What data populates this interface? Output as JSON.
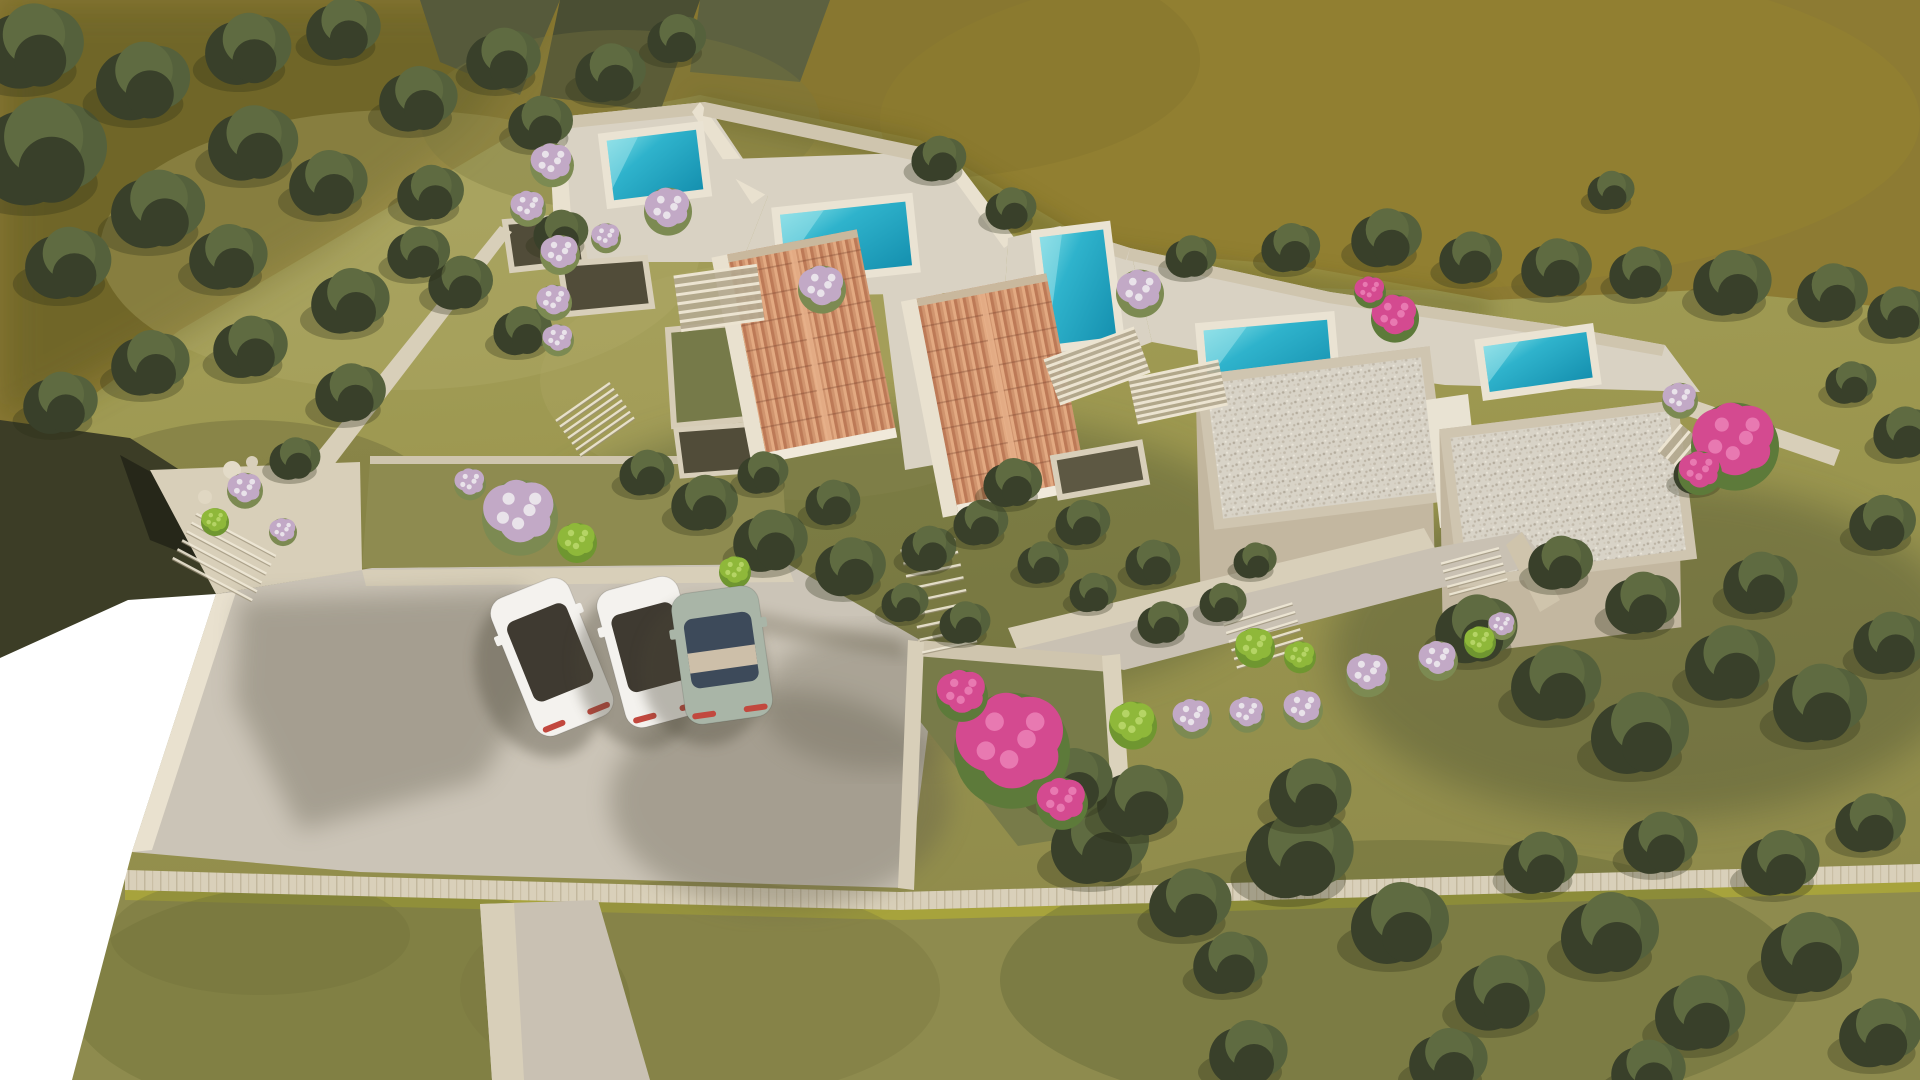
{
  "meta": {
    "title": "Aerial 3D architectural rendering - hillside villa complex",
    "description": "Top-down aerial render of a terraced Mediterranean villa development on an olive hillside: five turquoise pools, two terracotta gable roofs, two gravel flat-roof volumes, stone retaining walls, bougainvillea and lilac shrubs, a beige parking court with three parked cars, long stone boundary wall with lawn below, and an unrendered white wedge at the lower left."
  },
  "counts": {
    "pools": 5,
    "cars": 3,
    "terracotta_roofs": 2,
    "gravel_roof_volumes": 2,
    "pergola_stairs": 4
  },
  "palette": {
    "upland": "#8d7b33",
    "upland_shadow": "#6b6228",
    "cliff_a": "#565a3b",
    "cliff_b": "#4a4e33",
    "cliff_c": "#5d6140",
    "hill_base": "#9f9a58",
    "hill_light": "#b2ad6a",
    "hill_dark": "#75733f",
    "dark_wedge": "#3c3d26",
    "dark_wedge_deep": "#20221697",
    "white_cut": "#ffffff",
    "lawn": "#8e8b4e",
    "lawn_stripe": "#a7a33c",
    "lawn_dark": "#6f7038",
    "terrace": "#d9d2c3",
    "terrace_bright": "#e9e1cf",
    "stone_rim": "#cfc5ae",
    "stone_wall": "#d8cfb9",
    "wall_shade": "#b4a98f",
    "well_dark": "#514c39",
    "court_green": "#767a49",
    "parking": "#cbc4b7",
    "parking_shadow": "#5f5a4880",
    "path": "#c9c1b3",
    "pool_coping": "#eae3d3",
    "pool_light": "#9ae2e9",
    "tree_dark": "#39402a",
    "tree_mid": "#55613c",
    "tree_light": "#5f6b41",
    "tree_shadow": "#2a2f17",
    "bush_leaf": "#7c8a52",
    "car_white": "#f4f2ee",
    "car_sage": "#a9b5a7",
    "car_glass_dark": "#3f3a31",
    "car_glass_blue": "#3d4a5a",
    "car_taillight": "#c2483e",
    "slat_base": "#b3a88f",
    "slat_line": "#ece4d1",
    "step_line": "#efe8d6"
  },
  "bush_styles": {
    "lilac": {
      "main": "#c2a9c6",
      "hi": "#e9e3ea",
      "leaf": "#7c8a52"
    },
    "pink": {
      "main": "#d44a90",
      "hi": "#e879b1",
      "leaf": "#5d7a3a"
    },
    "green": {
      "main": "#8fb83a",
      "hi": "#b5d465",
      "leaf": "#6f9630"
    }
  },
  "scene": {
    "pools": [
      {
        "name": "pool-upper-left",
        "x": 655,
        "y": 165,
        "w": 90,
        "h": 60,
        "rot": -7
      },
      {
        "name": "pool-center",
        "x": 846,
        "y": 240,
        "w": 126,
        "h": 64,
        "rot": -6
      },
      {
        "name": "pool-mid-right",
        "x": 1078,
        "y": 287,
        "w": 64,
        "h": 108,
        "rot": -7
      },
      {
        "name": "pool-right",
        "x": 1268,
        "y": 356,
        "w": 124,
        "h": 62,
        "rot": -5
      },
      {
        "name": "pool-far-right",
        "x": 1538,
        "y": 362,
        "w": 104,
        "h": 46,
        "rot": -8
      }
    ],
    "pergolas": [
      {
        "x": 719,
        "y": 298,
        "w": 84,
        "h": 54,
        "rot": -8,
        "lines": 7
      },
      {
        "x": 1097,
        "y": 366,
        "w": 96,
        "h": 46,
        "rot": -20,
        "lines": 8
      },
      {
        "x": 1178,
        "y": 392,
        "w": 92,
        "h": 44,
        "rot": -12,
        "lines": 8
      },
      {
        "x": 1690,
        "y": 455,
        "w": 36,
        "h": 52,
        "rot": -50,
        "lines": 6
      }
    ],
    "stairs": [
      {
        "x": 583,
        "y": 402,
        "rot": -35,
        "len": 66,
        "count": 7,
        "gap": 7
      },
      {
        "x": 928,
        "y": 545,
        "rot": -12,
        "len": 56,
        "count": 9,
        "gap": 13
      },
      {
        "x": 1258,
        "y": 614,
        "rot": -17,
        "len": 72,
        "count": 6,
        "gap": 9
      },
      {
        "x": 1470,
        "y": 556,
        "rot": -15,
        "len": 60,
        "count": 5,
        "gap": 8
      },
      {
        "x": 236,
        "y": 535,
        "rot": 28,
        "len": 90,
        "count": 6,
        "gap": 10
      }
    ],
    "cars": [
      {
        "name": "car-white-1",
        "x": 552,
        "y": 657,
        "w": 84,
        "h": 148,
        "rot": -22,
        "body": "car_white",
        "glass": "car_glass_dark",
        "band": false
      },
      {
        "name": "car-white-2",
        "x": 652,
        "y": 652,
        "w": 84,
        "h": 142,
        "rot": -15,
        "body": "car_white",
        "glass": "car_glass_dark",
        "band": false
      },
      {
        "name": "car-sage",
        "x": 722,
        "y": 655,
        "w": 88,
        "h": 132,
        "rot": -8,
        "body": "car_sage",
        "glass": "car_glass_blue",
        "band": true
      }
    ],
    "trees": [
      [
        45,
        150,
        66
      ],
      [
        35,
        45,
        52
      ],
      [
        145,
        80,
        48
      ],
      [
        250,
        48,
        44
      ],
      [
        345,
        28,
        38
      ],
      [
        255,
        142,
        46
      ],
      [
        160,
        208,
        48
      ],
      [
        70,
        262,
        44
      ],
      [
        230,
        256,
        40
      ],
      [
        330,
        182,
        40
      ],
      [
        420,
        98,
        40
      ],
      [
        505,
        58,
        38
      ],
      [
        432,
        192,
        34
      ],
      [
        352,
        300,
        40
      ],
      [
        252,
        346,
        38
      ],
      [
        152,
        362,
        40
      ],
      [
        62,
        402,
        38
      ],
      [
        462,
        282,
        33
      ],
      [
        542,
        122,
        33
      ],
      [
        612,
        72,
        36
      ],
      [
        678,
        38,
        30
      ],
      [
        562,
        232,
        28
      ],
      [
        524,
        330,
        30
      ],
      [
        420,
        252,
        32
      ],
      [
        352,
        392,
        36
      ],
      [
        296,
        458,
        26
      ],
      [
        940,
        158,
        28
      ],
      [
        1012,
        208,
        26
      ],
      [
        1192,
        256,
        26
      ],
      [
        1292,
        247,
        30
      ],
      [
        1388,
        237,
        36
      ],
      [
        1472,
        257,
        32
      ],
      [
        1558,
        267,
        36
      ],
      [
        1642,
        272,
        32
      ],
      [
        1734,
        282,
        40
      ],
      [
        1834,
        292,
        36
      ],
      [
        1900,
        312,
        32
      ],
      [
        1612,
        190,
        24
      ],
      [
        648,
        472,
        28
      ],
      [
        706,
        502,
        34
      ],
      [
        772,
        540,
        38
      ],
      [
        852,
        566,
        36
      ],
      [
        930,
        548,
        28
      ],
      [
        764,
        472,
        26
      ],
      [
        834,
        502,
        28
      ],
      [
        982,
        522,
        28
      ],
      [
        1044,
        562,
        26
      ],
      [
        906,
        602,
        24
      ],
      [
        966,
        622,
        26
      ],
      [
        1094,
        592,
        24
      ],
      [
        1164,
        622,
        26
      ],
      [
        1014,
        482,
        30
      ],
      [
        1084,
        522,
        28
      ],
      [
        1154,
        562,
        28
      ],
      [
        1224,
        602,
        24
      ],
      [
        1256,
        560,
        22
      ],
      [
        1478,
        628,
        42
      ],
      [
        1558,
        682,
        46
      ],
      [
        1642,
        732,
        50
      ],
      [
        1732,
        662,
        46
      ],
      [
        1822,
        702,
        48
      ],
      [
        1892,
        642,
        38
      ],
      [
        1762,
        582,
        38
      ],
      [
        1644,
        602,
        38
      ],
      [
        1562,
        562,
        33
      ],
      [
        1884,
        522,
        34
      ],
      [
        1906,
        432,
        32
      ],
      [
        1852,
        382,
        26
      ],
      [
        1700,
        472,
        26
      ],
      [
        1102,
        842,
        50
      ],
      [
        1192,
        902,
        42
      ],
      [
        1302,
        852,
        55
      ],
      [
        1232,
        962,
        38
      ],
      [
        1402,
        922,
        50
      ],
      [
        1502,
        992,
        46
      ],
      [
        1612,
        932,
        50
      ],
      [
        1702,
        1012,
        46
      ],
      [
        1812,
        952,
        50
      ],
      [
        1882,
        1032,
        42
      ],
      [
        1542,
        862,
        38
      ],
      [
        1662,
        842,
        38
      ],
      [
        1782,
        862,
        40
      ],
      [
        1872,
        822,
        36
      ],
      [
        1142,
        800,
        44
      ],
      [
        1312,
        792,
        42
      ],
      [
        1250,
        1052,
        40
      ],
      [
        1450,
        1060,
        40
      ],
      [
        1650,
        1070,
        38
      ],
      [
        1075,
        780,
        40
      ]
    ],
    "bushes": [
      [
        552,
        162,
        22,
        "lilac"
      ],
      [
        528,
        206,
        18,
        "lilac"
      ],
      [
        560,
        252,
        20,
        "lilac"
      ],
      [
        554,
        300,
        18,
        "lilac"
      ],
      [
        558,
        338,
        16,
        "lilac"
      ],
      [
        606,
        236,
        15,
        "lilac"
      ],
      [
        668,
        208,
        24,
        "lilac"
      ],
      [
        822,
        286,
        24,
        "lilac"
      ],
      [
        1140,
        290,
        24,
        "lilac"
      ],
      [
        1680,
        398,
        18,
        "lilac"
      ],
      [
        245,
        488,
        18,
        "lilac"
      ],
      [
        283,
        530,
        14,
        "lilac"
      ],
      [
        520,
        512,
        38,
        "lilac"
      ],
      [
        470,
        482,
        16,
        "lilac"
      ],
      [
        1192,
        716,
        20,
        "lilac"
      ],
      [
        1247,
        712,
        18,
        "lilac"
      ],
      [
        1303,
        707,
        20,
        "lilac"
      ],
      [
        1368,
        672,
        22,
        "lilac"
      ],
      [
        1438,
        658,
        20,
        "lilac"
      ],
      [
        1502,
        624,
        14,
        "lilac"
      ],
      [
        1133,
        722,
        24,
        "green"
      ],
      [
        1480,
        640,
        16,
        "green"
      ],
      [
        215,
        520,
        14,
        "green"
      ],
      [
        577,
        540,
        20,
        "green"
      ],
      [
        735,
        570,
        16,
        "green"
      ],
      [
        1255,
        645,
        20,
        "green"
      ],
      [
        1300,
        655,
        16,
        "green"
      ],
      [
        1012,
        742,
        58,
        "pink"
      ],
      [
        962,
        692,
        26,
        "pink"
      ],
      [
        1062,
        800,
        26,
        "pink"
      ],
      [
        1735,
        440,
        44,
        "pink"
      ],
      [
        1700,
        470,
        22,
        "pink"
      ],
      [
        1395,
        315,
        24,
        "pink"
      ],
      [
        1370,
        290,
        16,
        "pink"
      ]
    ]
  }
}
